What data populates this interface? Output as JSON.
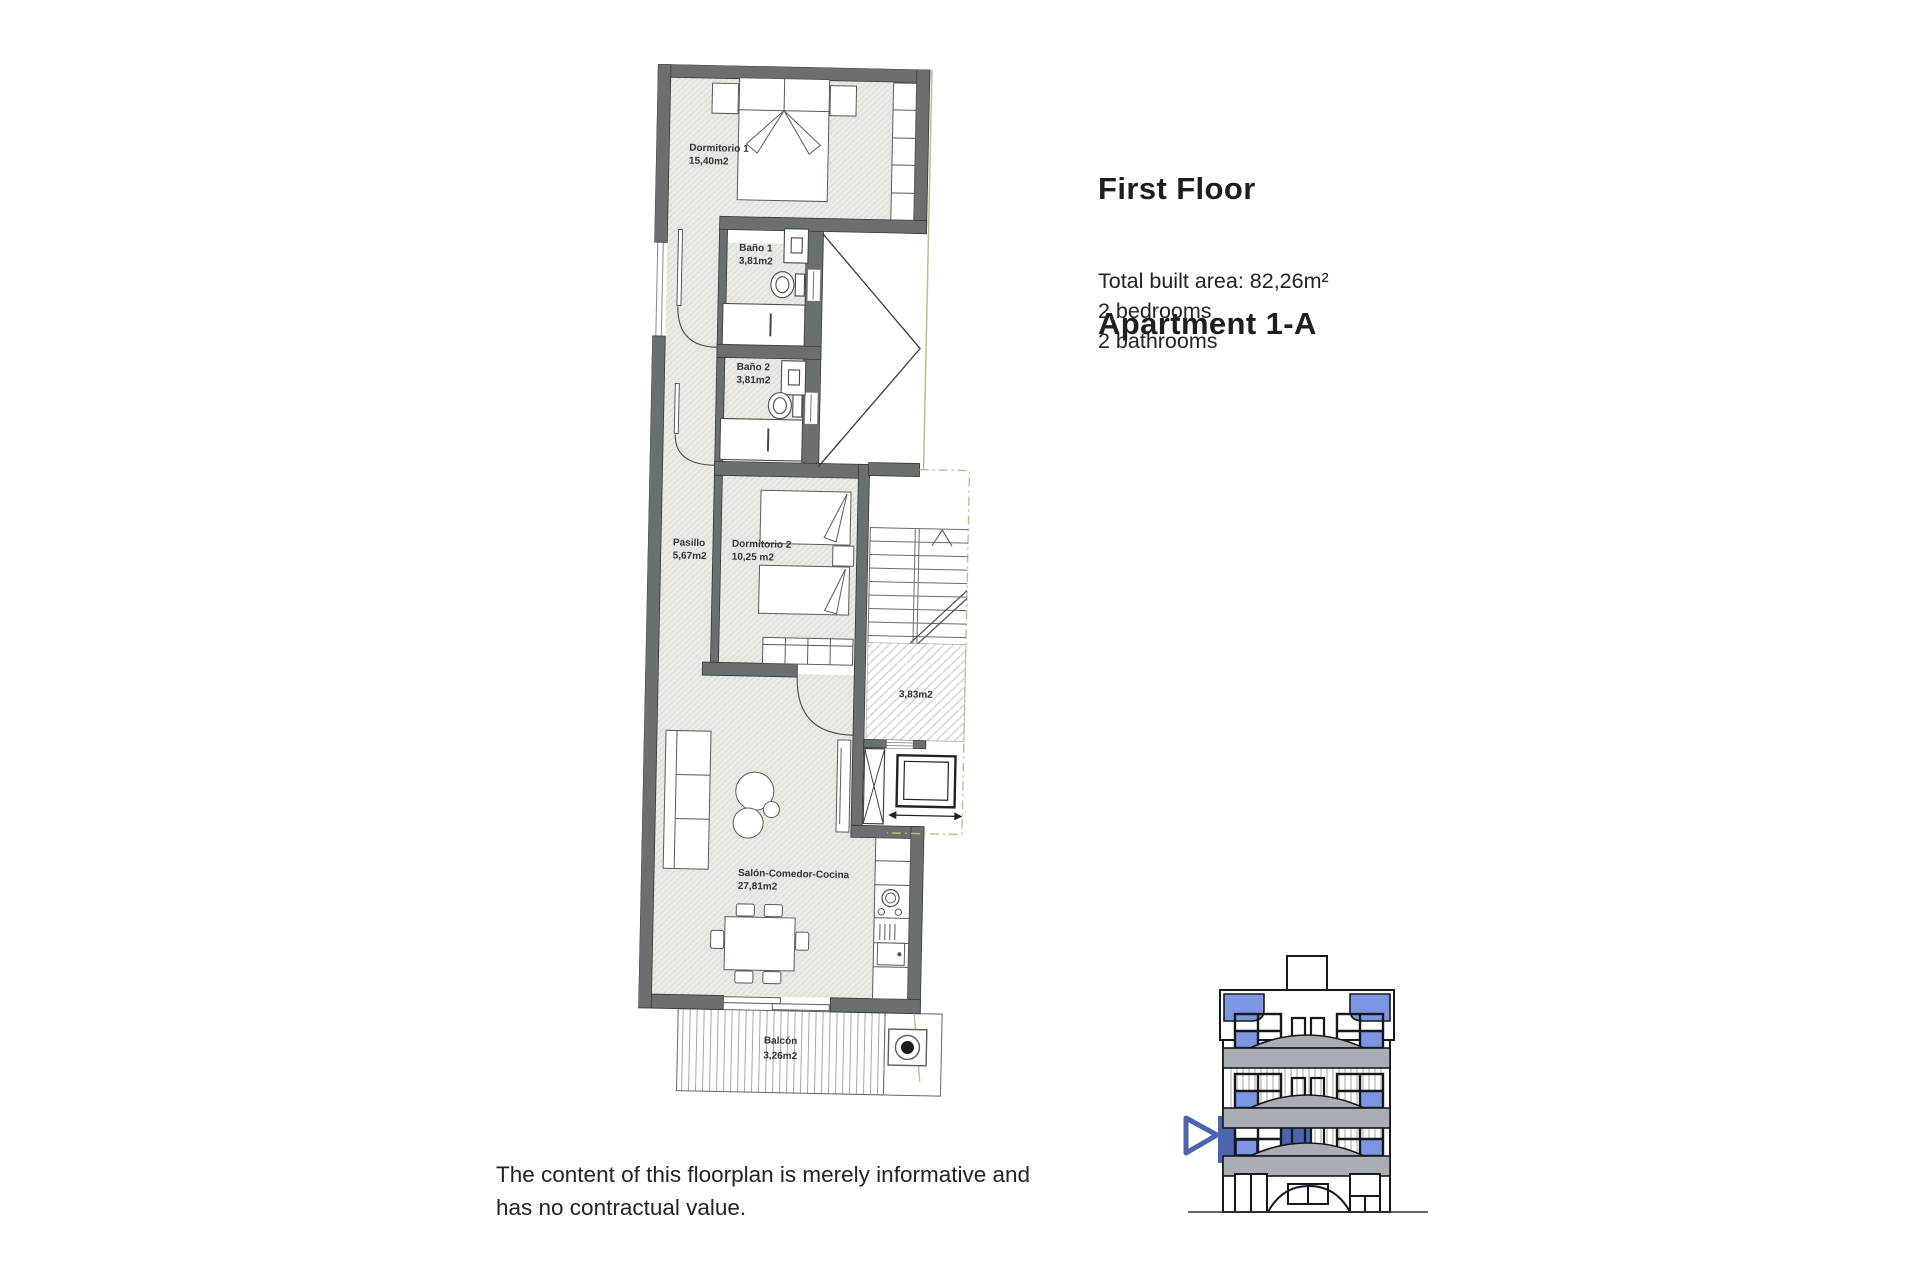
{
  "title": {
    "line1": "First Floor",
    "line2": "Apartment 1-A"
  },
  "summary": {
    "built_area": "Total built area: 82,26m²",
    "bedrooms": "2 bedrooms",
    "bathrooms": "2 bathrooms"
  },
  "disclaimer": {
    "line1": "The content of this floorplan is merely informative and",
    "line2": "has no contractual value."
  },
  "floorplan": {
    "rooms": [
      {
        "name": "Dormitorio 1",
        "area": "15,40m2"
      },
      {
        "name": "Baño 1",
        "area": "3,81m2"
      },
      {
        "name": "Baño 2",
        "area": "3,81m2"
      },
      {
        "name": "Pasillo",
        "area": "5,67m2"
      },
      {
        "name": "Dormitorio 2",
        "area": "10,25 m2"
      },
      {
        "area": "3,83m2"
      },
      {
        "name": "Salón-Comedor-Cocina",
        "area": "27,81m2"
      },
      {
        "name": "Balcón",
        "area": "3,26m2"
      }
    ]
  },
  "colors": {
    "wall_gray": "#6b6f70",
    "floor_fill": "#eaeae6",
    "accent_blue": "#4d65af",
    "window_blue": "#7d96e2",
    "balcony_slab_gray": "#a9aeb4",
    "boundary_olive": "#b9c08e"
  }
}
